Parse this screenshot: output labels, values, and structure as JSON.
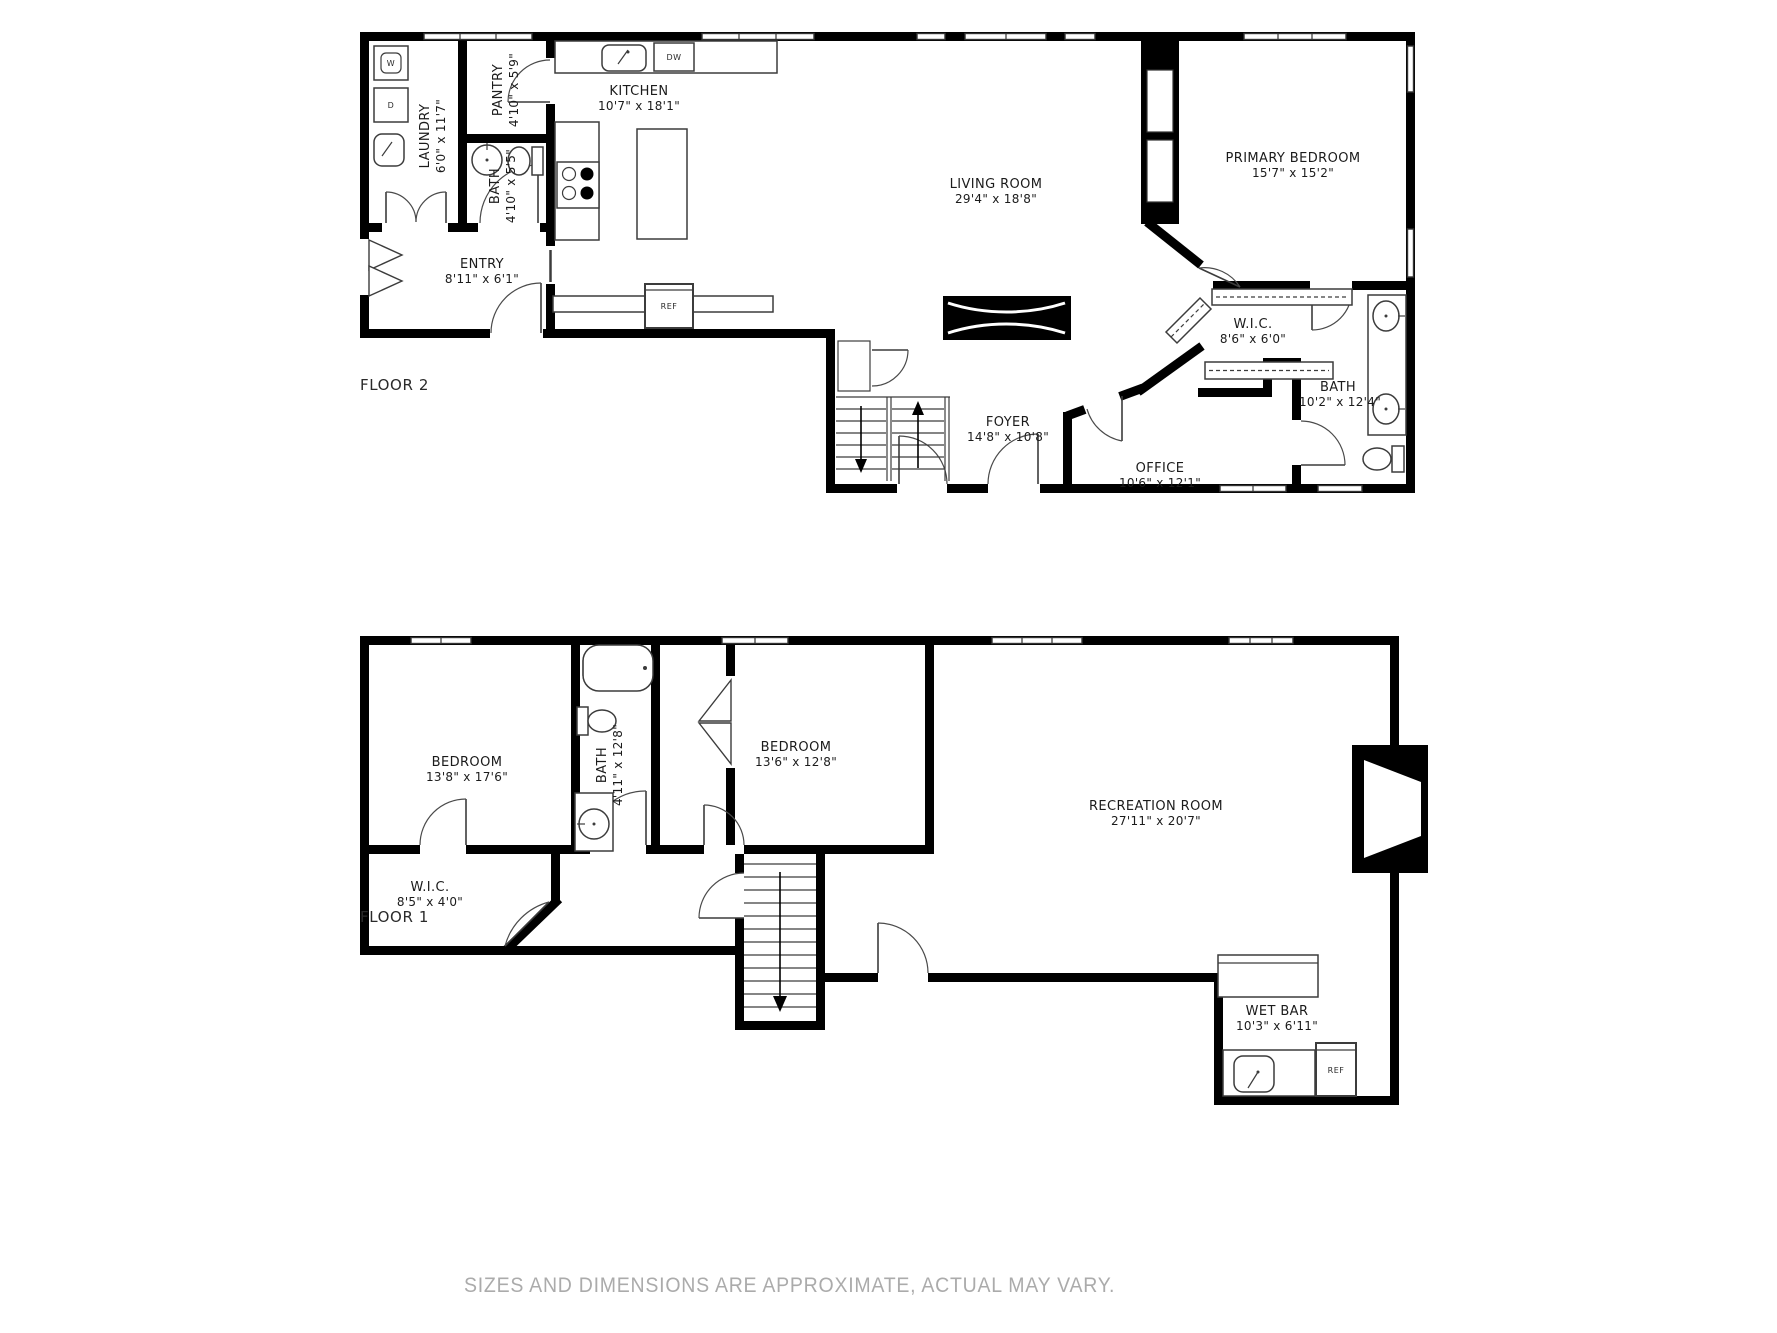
{
  "page": {
    "floor2_label": "FLOOR 2",
    "floor1_label": "FLOOR 1",
    "disclaimer": "SIZES AND DIMENSIONS ARE APPROXIMATE, ACTUAL MAY VARY."
  },
  "floor2": {
    "rooms": [
      {
        "name": "LAUNDRY",
        "dims": "6'0\" x 11'7\""
      },
      {
        "name": "PANTRY",
        "dims": "4'10\" x 5'9\""
      },
      {
        "name": "BATH",
        "dims": "4'10\" x 5'5\""
      },
      {
        "name": "KITCHEN",
        "dims": "10'7\" x 18'1\""
      },
      {
        "name": "ENTRY",
        "dims": "8'11\" x 6'1\""
      },
      {
        "name": "LIVING ROOM",
        "dims": "29'4\" x 18'8\""
      },
      {
        "name": "PRIMARY BEDROOM",
        "dims": "15'7\" x 15'2\""
      },
      {
        "name": "W.I.C.",
        "dims": "8'6\" x 6'0\""
      },
      {
        "name": "BATH",
        "dims": "10'2\" x 12'4\""
      },
      {
        "name": "FOYER",
        "dims": "14'8\" x 10'8\""
      },
      {
        "name": "OFFICE",
        "dims": "10'6\" x 12'1\""
      }
    ],
    "appliances": {
      "washer": "W",
      "dryer": "D",
      "dishwasher": "DW",
      "refrigerator": "REF"
    }
  },
  "floor1": {
    "rooms": [
      {
        "name": "BEDROOM",
        "dims": "13'8\" x 17'6\""
      },
      {
        "name": "BATH",
        "dims": "4'11\" x 12'8\""
      },
      {
        "name": "BEDROOM",
        "dims": "13'6\" x 12'8\""
      },
      {
        "name": "RECREATION ROOM",
        "dims": "27'11\" x 20'7\""
      },
      {
        "name": "W.I.C.",
        "dims": "8'5\" x 4'0\""
      },
      {
        "name": "WET BAR",
        "dims": "10'3\" x 6'11\""
      }
    ],
    "appliances": {
      "refrigerator": "REF"
    }
  },
  "colors": {
    "wall": "#000000",
    "background": "#ffffff",
    "line": "#3c3c3c",
    "label_text": "#1b1b1b",
    "disclaimer_text": "#ababab"
  }
}
